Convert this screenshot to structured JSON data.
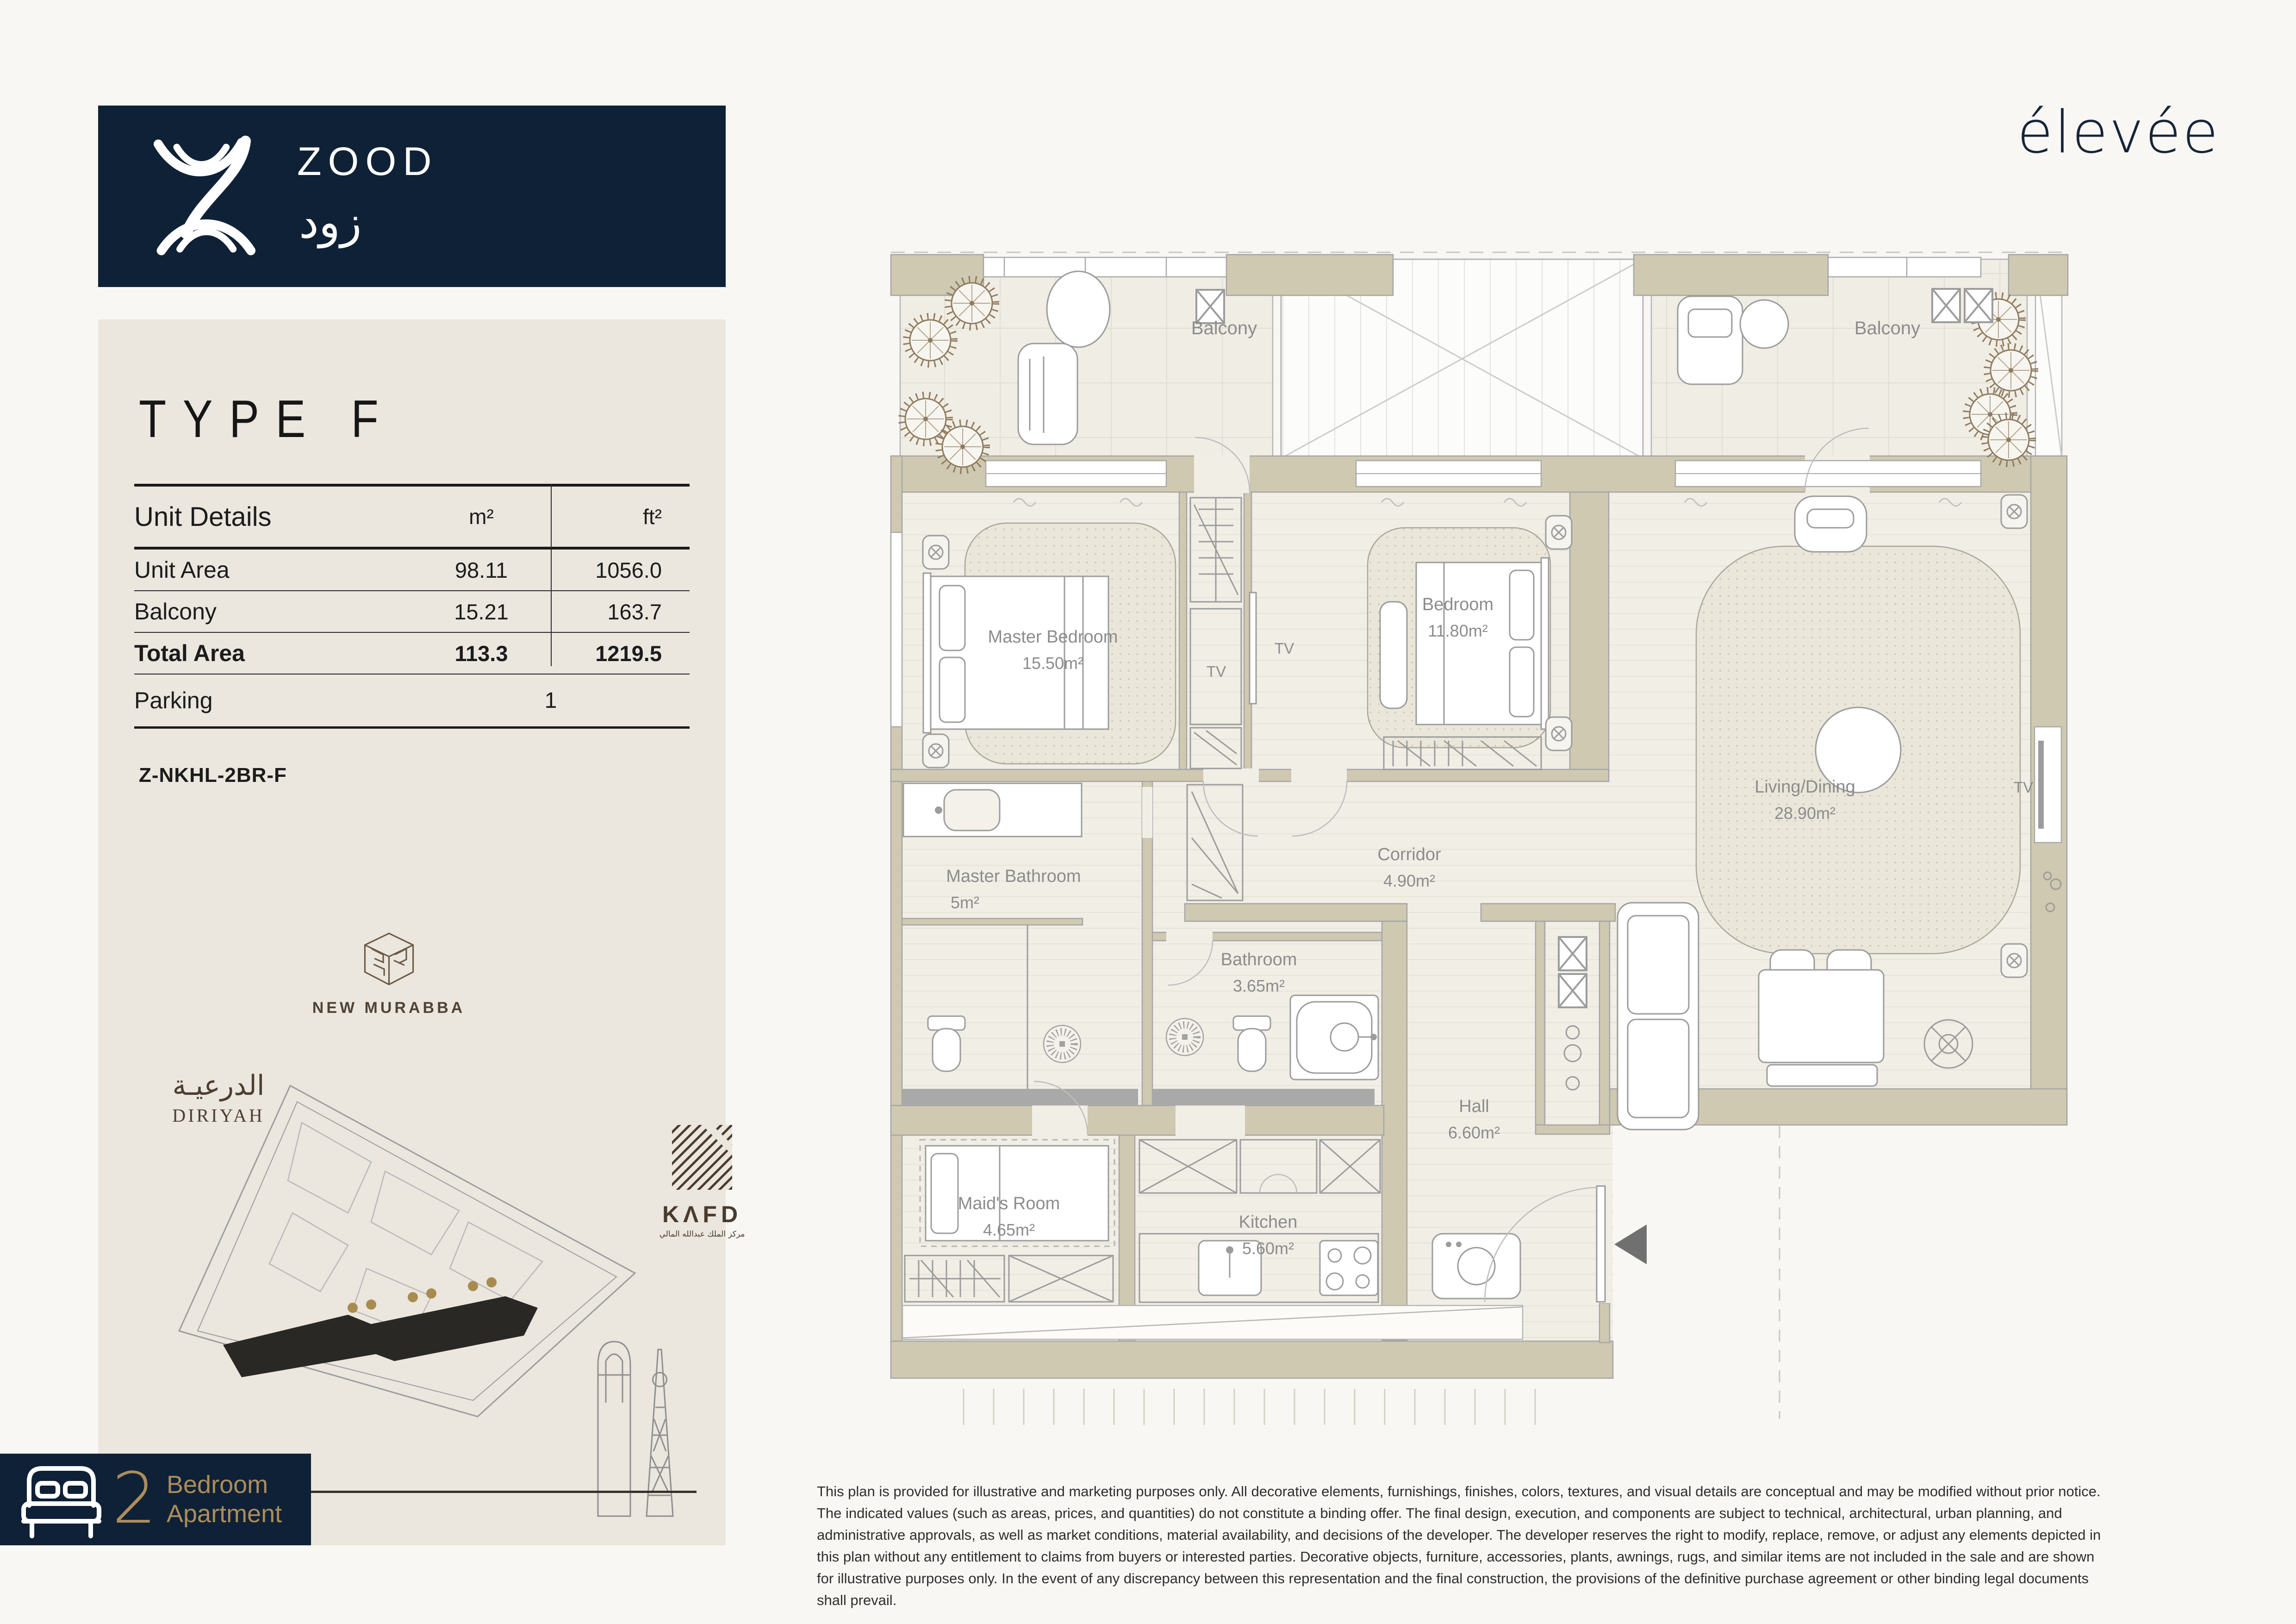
{
  "brand": {
    "name": "ZOOD",
    "name_ar": "زود",
    "navy": "#0f2136",
    "gold": "#ab8d5c"
  },
  "developer": {
    "logo": "élevée"
  },
  "unit": {
    "title": "TYPE F",
    "code": "Z-NKHL-2BR-F",
    "badge": {
      "number": "2",
      "line1": "Bedroom",
      "line2": "Apartment"
    }
  },
  "details": {
    "header": {
      "label": "Unit Details",
      "m2": "m²",
      "ft2": "ft²"
    },
    "rows": [
      {
        "label": "Unit Area",
        "m2": "98.11",
        "ft2": "1056.0"
      },
      {
        "label": "Balcony",
        "m2": "15.21",
        "ft2": "163.7"
      },
      {
        "label": "Total Area",
        "m2": "113.3",
        "ft2": "1219.5"
      }
    ],
    "parking": {
      "label": "Parking",
      "value": "1"
    }
  },
  "landmarks": {
    "new_murabba": "NEW MURABBA",
    "diriyah_ar": "الدرعيـة",
    "diriyah_en": "DIRIYAH",
    "kafd_en": "KΛFD",
    "kafd_ar": "مركز الملك عبدالله المالي"
  },
  "floor_plan": {
    "balcony_left": "Balcony",
    "balcony_right": "Balcony",
    "tv": "TV",
    "rooms": [
      {
        "name": "Master Bedroom",
        "area": "15.50m²"
      },
      {
        "name": "Bedroom",
        "area": "11.80m²"
      },
      {
        "name": "Living/Dining",
        "area": "28.90m²"
      },
      {
        "name": "Corridor",
        "area": "4.90m²"
      },
      {
        "name": "Master Bathroom",
        "area": "5m²"
      },
      {
        "name": "Bathroom",
        "area": "3.65m²"
      },
      {
        "name": "Hall",
        "area": "6.60m²"
      },
      {
        "name": "Maid's Room",
        "area": "4.65m²"
      },
      {
        "name": "Kitchen",
        "area": "5.60m²"
      }
    ]
  },
  "disclaimer": "This plan is provided for illustrative and marketing purposes only. All decorative elements, furnishings, finishes, colors, textures, and visual details are conceptual and may be modified without prior notice. The indicated values (such as areas, prices, and quantities) do not constitute a binding offer. The final design, execution, and components are subject to technical, architectural, urban planning, and administrative approvals, as well as market conditions, material availability, and decisions of the developer. The developer reserves the right to modify, replace, remove, or adjust any elements depicted in this plan without any entitlement to claims from buyers or interested parties. Decorative objects, furniture, accessories, plants, awnings, rugs, and similar items are not included in the sale and are shown for illustrative purposes only. In the event of any discrepancy between this representation and the final construction, the provisions of the definitive purchase agreement or other binding legal documents shall prevail."
}
